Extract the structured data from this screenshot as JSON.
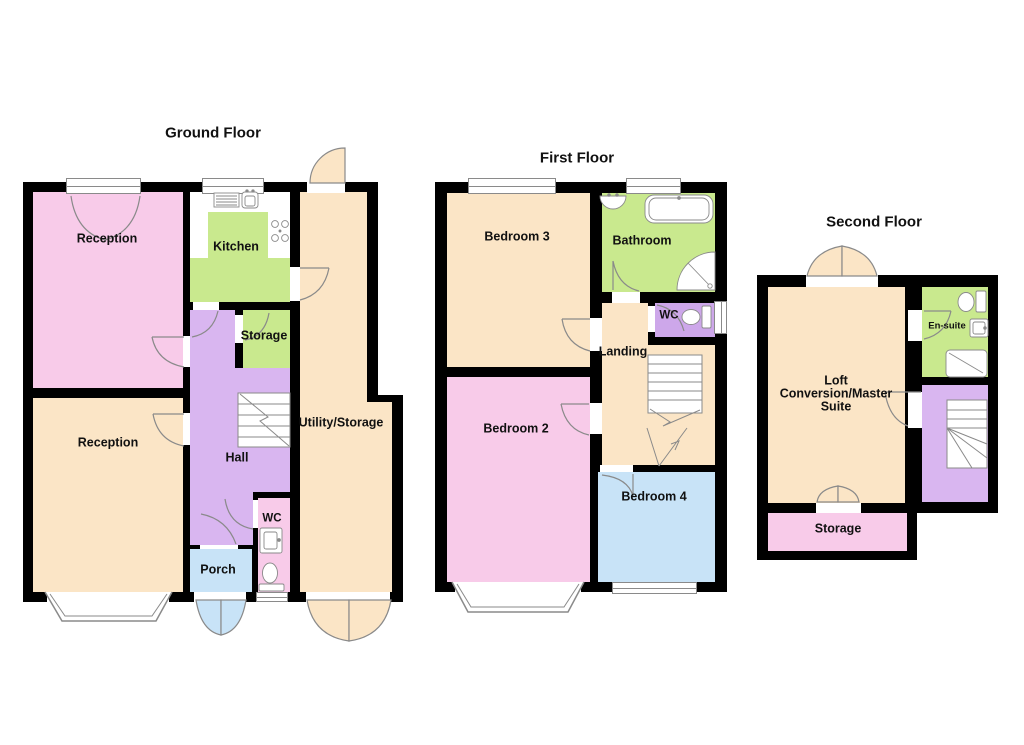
{
  "document": {
    "type": "floorplan",
    "background": "#ffffff"
  },
  "palette": {
    "wall": "#000000",
    "pink": "#f8cbe9",
    "peach": "#fbe5c6",
    "green": "#c9e98e",
    "purple": "#d9b6f0",
    "blue": "#c8e3f7",
    "outline": "#8a8a8a",
    "text": "#111111"
  },
  "floors": {
    "ground": {
      "title": "Ground Floor",
      "rooms": {
        "reception1": {
          "label": "Reception"
        },
        "kitchen": {
          "label": "Kitchen"
        },
        "storage": {
          "label": "Storage"
        },
        "utility": {
          "label": "Utility/Storage"
        },
        "hall": {
          "label": "Hall"
        },
        "reception2": {
          "label": "Reception"
        },
        "wc": {
          "label": "WC"
        },
        "porch": {
          "label": "Porch"
        }
      },
      "fixtures": [
        "kitchen-sink",
        "drainer",
        "hob",
        "wc-sink",
        "wc-toilet",
        "stairs",
        "bay-window"
      ]
    },
    "first": {
      "title": "First Floor",
      "rooms": {
        "bedroom3": {
          "label": "Bedroom 3"
        },
        "bathroom": {
          "label": "Bathroom"
        },
        "wc": {
          "label": "WC"
        },
        "landing": {
          "label": "Landing"
        },
        "bedroom2": {
          "label": "Bedroom 2"
        },
        "bedroom4": {
          "label": "Bedroom 4"
        }
      },
      "fixtures": [
        "basin",
        "bath",
        "corner-shower",
        "wc-toilet",
        "stairs",
        "bay-window"
      ]
    },
    "second": {
      "title": "Second Floor",
      "rooms": {
        "loft": {
          "label_line1": "Loft",
          "label_line2": "Conversion/Master",
          "label_line3": "Suite"
        },
        "ensuite": {
          "label": "En-suite"
        },
        "storage": {
          "label": "Storage"
        }
      },
      "fixtures": [
        "toilet",
        "basin",
        "shower",
        "stairs"
      ]
    }
  }
}
